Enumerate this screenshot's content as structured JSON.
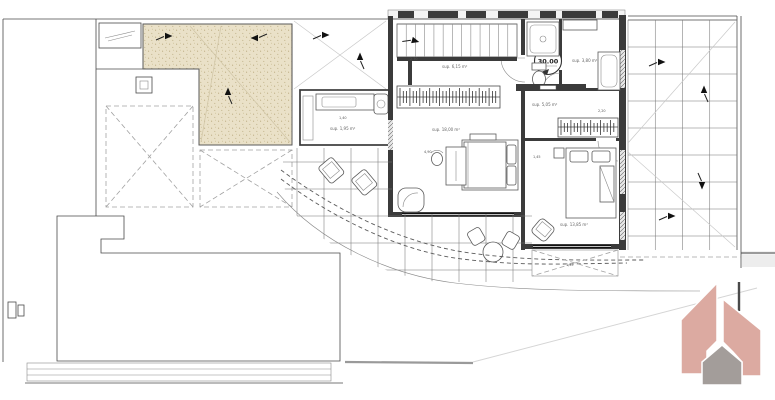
{
  "plan": {
    "level_marker": {
      "value": "30.00"
    },
    "rooms": {
      "dressing": {
        "area": "sup. 6,15 m²"
      },
      "master_bedroom": {
        "area": "sup. 18,00 m²"
      },
      "bathroom": {
        "area": "sup. 3,80 m²"
      },
      "hall": {
        "area": "sup. 5,05 m²"
      },
      "bedroom2": {
        "area": "sup. 13,85 m²"
      },
      "laundry": {
        "area": "sup. 1,95 m²"
      }
    },
    "dimensions": {
      "hall_width": "2,70",
      "laundry_width": "1,40",
      "master_width": "4,90",
      "bedroom2_gap": "1,45",
      "bath_width": "2,20",
      "awning_depth": "1,35"
    },
    "colors": {
      "sand_fill": "#eae1c8",
      "sand_dot": "#b5a578",
      "logo_salmon": "#dcaaa1",
      "logo_gray": "#a39d9a"
    }
  }
}
